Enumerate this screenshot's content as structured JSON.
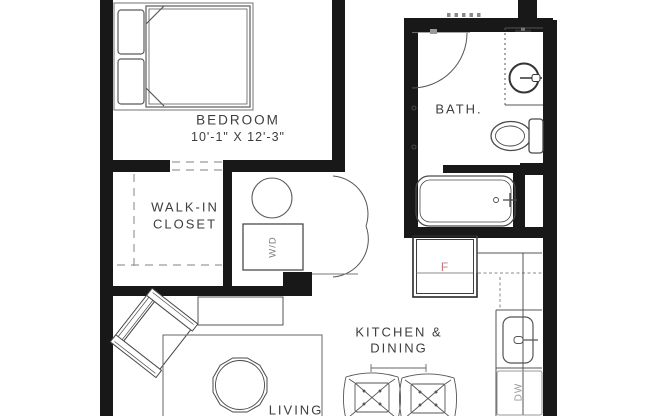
{
  "title": "Studio apartment floor plan",
  "colors": {
    "wall": "#181818",
    "furniture_line": "#4a4a4a",
    "light_line": "#999999",
    "text": "#3e3e3e",
    "fridge_accent": "#c4777b",
    "background": "#ffffff"
  },
  "rooms": {
    "bedroom": {
      "label": "BEDROOM",
      "dimensions": "10'-1\" X 12'-3\""
    },
    "closet": {
      "label_line1": "WALK-IN",
      "label_line2": "CLOSET"
    },
    "bath": {
      "label": "BATH."
    },
    "kitchen_dining": {
      "label_line1": "KITCHEN &",
      "label_line2": "DINING"
    },
    "living": {
      "label": "LIVING"
    }
  },
  "appliances": {
    "washer_dryer": "W/D",
    "dishwasher": "DW",
    "fridge": "F"
  }
}
